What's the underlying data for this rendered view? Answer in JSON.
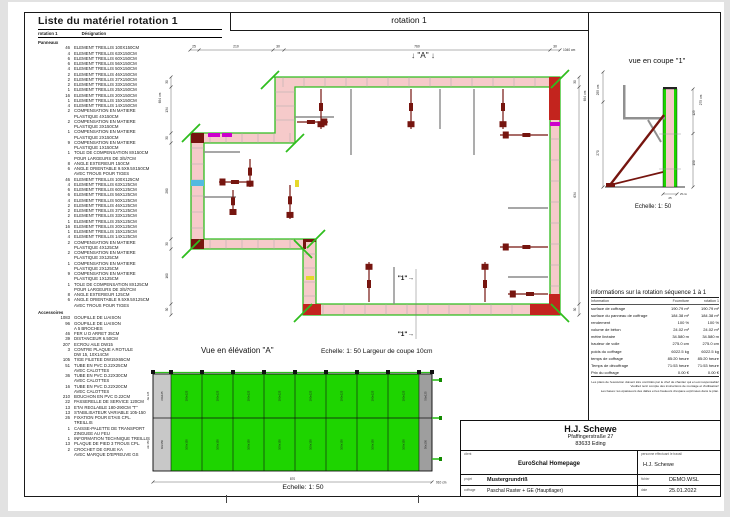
{
  "colors": {
    "panel_green": "#1ed400",
    "wall_pink": "#f6caca",
    "outline_green": "#2fbe1e",
    "brace_maroon": "#76150f",
    "stop_end_red": "#c3241e",
    "connector_purple": "#8b00a8",
    "compensation_magenta": "#cc00cc"
  },
  "material_list": {
    "title": "Liste du matériel  rotation 1",
    "header_col1": "rotation 1",
    "header_col2": "Désignation",
    "sections": [
      {
        "name": "Panneaux",
        "items": [
          {
            "q": "46",
            "t": "ELEMENT TREILLIS 100X150CM"
          },
          {
            "q": "4",
            "t": "ELEMENT TREILLIS 63X150CM"
          },
          {
            "q": "6",
            "t": "ELEMENT TREILLIS 60X150CM"
          },
          {
            "q": "6",
            "t": "ELEMENT TREILLIS 56X150CM"
          },
          {
            "q": "4",
            "t": "ELEMENT TREILLIS 50X150CM"
          },
          {
            "q": "2",
            "t": "ELEMENT TREILLIS 46X150CM"
          },
          {
            "q": "2",
            "t": "ELEMENT TREILLIS 37X150CM"
          },
          {
            "q": "2",
            "t": "ELEMENT TREILLIS 33X150CM"
          },
          {
            "q": "1",
            "t": "ELEMENT TREILLIS 25X150CM"
          },
          {
            "q": "16",
            "t": "ELEMENT TREILLIS 20X150CM"
          },
          {
            "q": "1",
            "t": "ELEMENT TREILLIS 15X150CM"
          },
          {
            "q": "4",
            "t": "ELEMENT TREILLIS 14X150CM"
          },
          {
            "q": "2",
            "t": "COMPENSATION EN MATIERE\nPLASTIQUE 4X150CM"
          },
          {
            "q": "2",
            "t": "COMPENSATION EN MATIERE\nPLASTIQUE 3X150CM"
          },
          {
            "q": "1",
            "t": "COMPENSATION EN MATIERE\nPLASTIQUE 2X150CM"
          },
          {
            "q": "9",
            "t": "COMPENSATION EN MATIERE\nPLASTIQUE 1X150CM"
          },
          {
            "q": "1",
            "t": "TOLE DE COMPENSATION 8X150CM\nPOUR LARGEURS DE 3/5/7CM"
          },
          {
            "q": "8",
            "t": "ANGLE EXTERIEUR 150CM"
          },
          {
            "q": "6",
            "t": "ANGLE ORIENTABLE 9.5X9.5X150CM\nAVEC TROUS POUR TIGES"
          },
          {
            "q": "46",
            "t": "ELEMENT TREILLIS 100X125CM"
          },
          {
            "q": "4",
            "t": "ELEMENT TREILLIS 63X125CM"
          },
          {
            "q": "6",
            "t": "ELEMENT TREILLIS 60X125CM"
          },
          {
            "q": "6",
            "t": "ELEMENT TREILLIS 56X125CM"
          },
          {
            "q": "4",
            "t": "ELEMENT TREILLIS 50X125CM"
          },
          {
            "q": "2",
            "t": "ELEMENT TREILLIS 46X125CM"
          },
          {
            "q": "2",
            "t": "ELEMENT TREILLIS 37X125CM"
          },
          {
            "q": "2",
            "t": "ELEMENT TREILLIS 33X125CM"
          },
          {
            "q": "1",
            "t": "ELEMENT TREILLIS 25X125CM"
          },
          {
            "q": "16",
            "t": "ELEMENT TREILLIS 20X125CM"
          },
          {
            "q": "1",
            "t": "ELEMENT TREILLIS 15X125CM"
          },
          {
            "q": "4",
            "t": "ELEMENT TREILLIS 14X125CM"
          },
          {
            "q": "2",
            "t": "COMPENSATION EN MATIERE\nPLASTIQUE 4X125CM"
          },
          {
            "q": "2",
            "t": "COMPENSATION EN MATIERE\nPLASTIQUE 3X125CM"
          },
          {
            "q": "1",
            "t": "COMPENSATION EN MATIERE\nPLASTIQUE 2X125CM"
          },
          {
            "q": "9",
            "t": "COMPENSATION EN MATIERE\nPLASTIQUE 1X125CM"
          },
          {
            "q": "1",
            "t": "TOLE DE COMPENSATION 8X125CM\nPOUR LARGEURS DE 3/5/7CM"
          },
          {
            "q": "8",
            "t": "ANGLE EXTERIEUR 125CM"
          },
          {
            "q": "6",
            "t": "ANGLE ORIENTABLE 9.5X9.5X125CM\nAVEC TROUS POUR TIGES"
          }
        ]
      },
      {
        "name": "Accessoires",
        "items": [
          {
            "q": "1083",
            "t": "GOUPILLE DE LIAISON"
          },
          {
            "q": "96",
            "t": "GOUPILLE DE LIAISON\nA 5 BROCHES"
          },
          {
            "q": "46",
            "t": "FER U D ARRET 35CM"
          },
          {
            "q": "39",
            "t": "DISTANCEUR 6.50CM"
          },
          {
            "q": "207",
            "t": "ECROU AILE DW15"
          },
          {
            "q": "3",
            "t": "CONTRE PLAQUE A ROTULE\nDW 15, 10X14CM"
          },
          {
            "q": "105",
            "t": "TIGE FILETEE DW15X65CM"
          },
          {
            "q": "51",
            "t": "TUBE EN PVC D.22X25CM\nAVEC CALOTTES"
          },
          {
            "q": "36",
            "t": "TUBE EN PVC D.22X30CM\nAVEC CALOTTES"
          },
          {
            "q": "16",
            "t": "TUBE EN PVC D.22X20CM\nAVEC CALOTTES"
          },
          {
            "q": "210",
            "t": "BOUCHON EN PVC D.22CM"
          },
          {
            "q": "22",
            "t": "PASSERELLE DE SERVICE 120CM"
          },
          {
            "q": "13",
            "t": "ETAI REGLABLE 180-290CM \"T\""
          },
          {
            "q": "13",
            "t": "STABILISATEUR VARIABLE 105-150"
          },
          {
            "q": "26",
            "t": "FIXATION POUR ETAIS CPL.\nTREILLIS"
          },
          {
            "q": "1",
            "t": "CAISSE-PALETTE DE TRANSPORT\nZINGUEE AU FEU"
          },
          {
            "q": "1",
            "t": "INFORMATION TECHNIQUE TREILLIS"
          },
          {
            "q": "13",
            "t": "PLAQUE DE PIED 3 TROUS CPL."
          },
          {
            "q": "2",
            "t": "CROCHET DE GRUE KA\nAVEC MARQUE D'EPREUVE GS"
          }
        ]
      }
    ]
  },
  "plan": {
    "title": "rotation 1",
    "marker_a": "↓ \"A\" ↓",
    "marker_section": "\"1\"→",
    "dims_top": [
      "25",
      "210",
      "30",
      "760",
      "30"
    ],
    "dims_top_total": "1040 cm",
    "dims_left_segs": [
      "30",
      "134",
      "30",
      "280",
      "30",
      "160",
      "30"
    ],
    "dims_left_total": "694 cm",
    "dims_right_segs": [
      "30",
      "634",
      "30"
    ],
    "dims_right_total": "694 cm"
  },
  "section_view": {
    "title": "vue en coupe \"1\"",
    "scale": "Echelle: 1: 50",
    "dim_left_total": "255 cm",
    "dim_left_seg": "270",
    "dim_right_total": "275 cm",
    "dim_right_segs": [
      "125",
      "150"
    ],
    "dim_bottom": "25",
    "dim_bottom_unit": "25 cm"
  },
  "info_table": {
    "title": "informations sur la rotation  séquence 1 à 1",
    "columns": [
      "Information",
      "Fourniture",
      "rotation 1"
    ],
    "rows": [
      [
        "surface de coffrage",
        "190.79 m²",
        "190.79 m²"
      ],
      [
        "surface du panneau de coffrage",
        "184.38 m²",
        "184.38 m²"
      ],
      [
        "rendement",
        "100 %",
        "100 %"
      ],
      [
        "volume de béton",
        "24.02 m³",
        "24.02 m³"
      ],
      [
        "mètre linéaire",
        "34.580 m",
        "34.580 m"
      ],
      [
        "hauteur de voile",
        "275.0 cm",
        "275.0 cm"
      ],
      [
        "poids du coffrage",
        "6022.5 kg",
        "6022.5 kg"
      ],
      [
        "temps de coffrage",
        "85:20 heure",
        "85:20 heure"
      ],
      [
        "Temps de décoffrage",
        "71:53 heure",
        "71:53 heure"
      ],
      [
        "Prix du coffrage",
        "0.00 €",
        "0.00 €"
      ]
    ],
    "disclaimer": [
      "Les plans de l'exécution doivent être contrôlés par le chef de chantier qui en est responsable!",
      "Veuillez tenir compte des instructions de montage et d'utilisation!",
      "Les bases: les épaisseurs des dalles et les hauteurs d'espace exprimées dans le plan."
    ]
  },
  "elevation": {
    "title": "Vue en élévation \"A\"",
    "subtitle": "Echelle: 1: 50   Largeur de coupe 10cm",
    "scale": "Echelle: 1: 50",
    "left_col": {
      "top": "60x125",
      "bottom": "60x150"
    },
    "mid_col": {
      "top": "100x125",
      "bottom": "100x150",
      "count": 8
    },
    "right_col": {
      "top": "50x125",
      "bottom": "50x150"
    },
    "side_labels": [
      "AE 125",
      "AE 150"
    ],
    "dim_span": "870",
    "dim_total": "910 cm"
  },
  "title_block": {
    "company": "H.J. Schewe",
    "address1": "Pfaffingerstraße 27",
    "address2": "83633 Eding",
    "client_label": "client",
    "client": "EuroSchal Homepage",
    "worker_label": "personne effectuant le travail",
    "worker": "H.J. Schewe",
    "project_label": "projet",
    "project": "Mustergrundriß",
    "file_label": "fichier",
    "file": "DEMO.WSL",
    "formwork_label": "coffrage",
    "formwork": "Paschal Raster + GE (Hauptlager)",
    "date_label": "date",
    "date": "25.01.2022"
  }
}
